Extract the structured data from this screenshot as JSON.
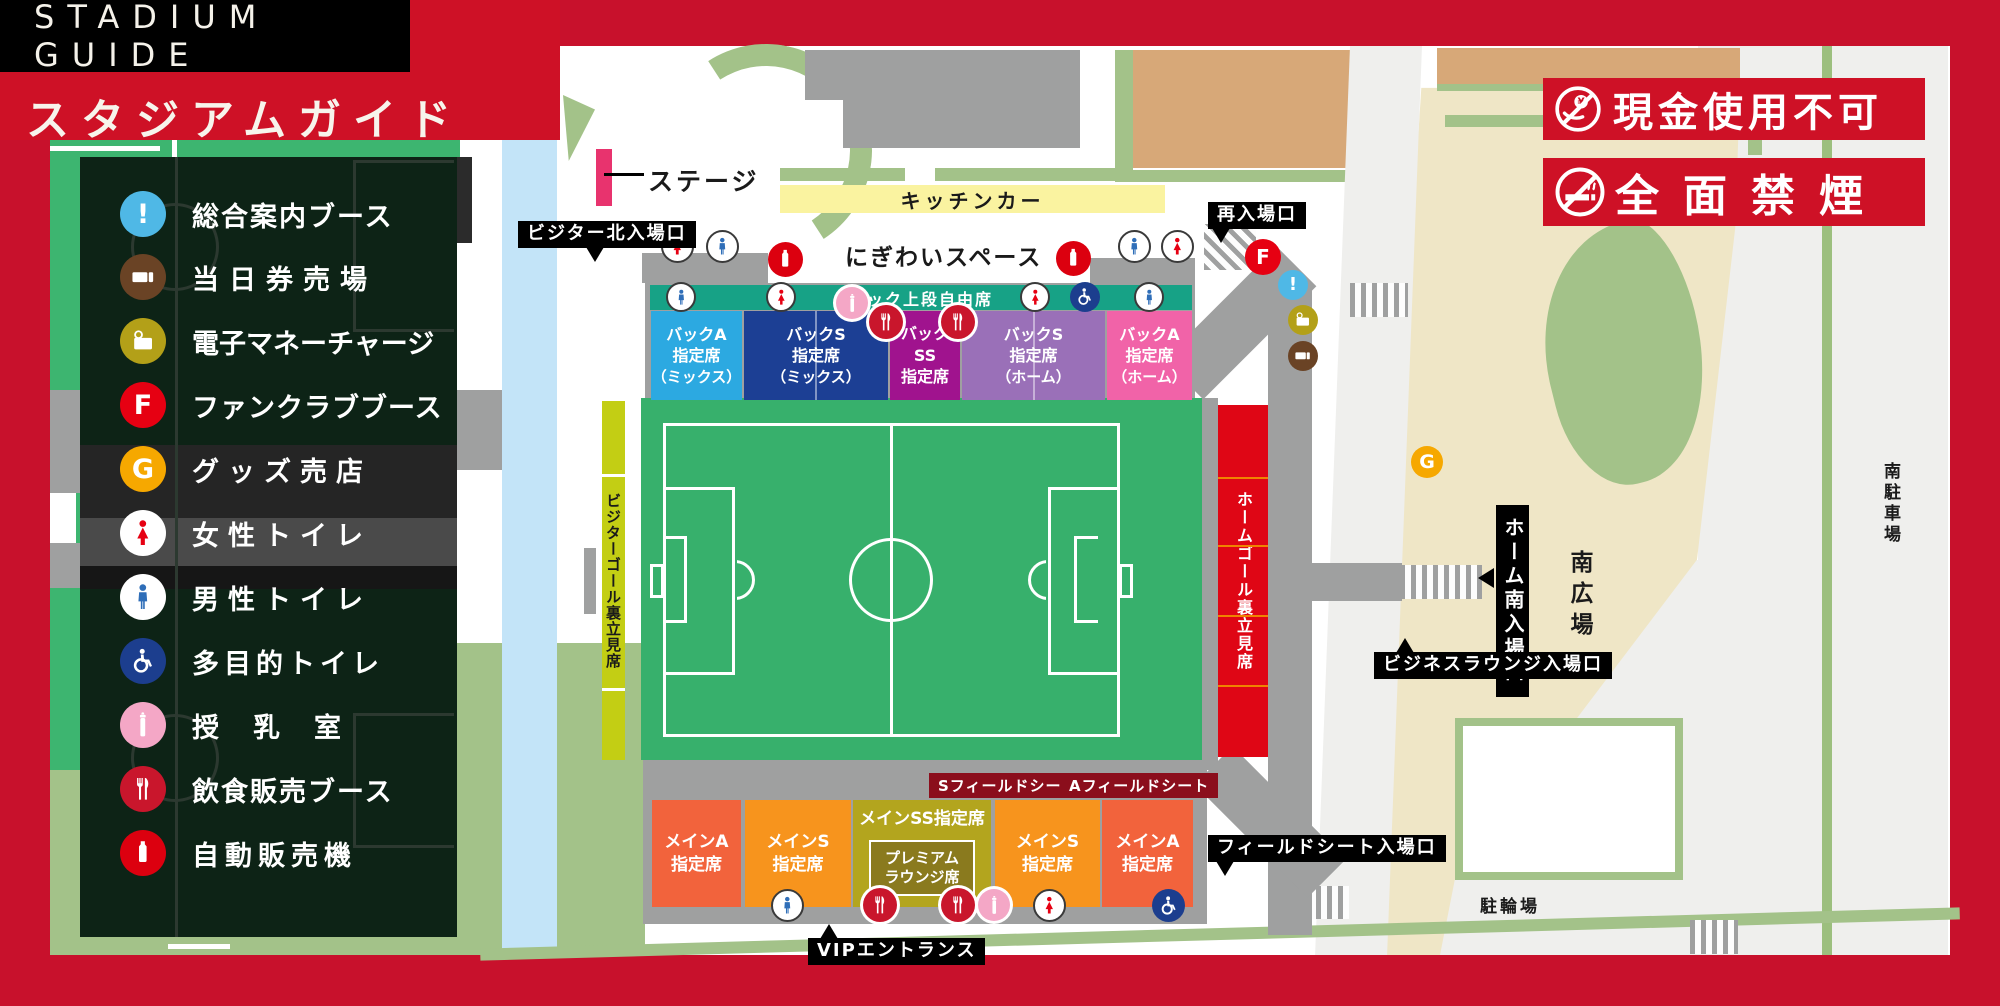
{
  "header": {
    "title_en": "STADIUM GUIDE",
    "title_ja": "スタジアムガイド"
  },
  "notices": [
    {
      "icon": "no-cash-icon",
      "label": "現金使用不可"
    },
    {
      "icon": "no-smoking-icon",
      "label": "全面禁煙"
    }
  ],
  "legend": {
    "items": [
      {
        "icon": "info-icon",
        "glyph": "!",
        "label": "総合案内ブース",
        "color": "#4FB8E6"
      },
      {
        "icon": "ticket-icon",
        "label": "当日券売場",
        "color": "#6A4325"
      },
      {
        "icon": "emoney-charge-icon",
        "label": "電子マネーチャージ",
        "color": "#B3A018"
      },
      {
        "icon": "fanclub-icon",
        "glyph": "F",
        "label": "ファンクラブブース",
        "color": "#E60012"
      },
      {
        "icon": "goods-icon",
        "glyph": "G",
        "label": "グッズ売店",
        "color": "#F6A800"
      },
      {
        "icon": "women-toilet-icon",
        "label": "女性トイレ",
        "color": "#E60012"
      },
      {
        "icon": "men-toilet-icon",
        "label": "男性トイレ",
        "color": "#2F6EB8"
      },
      {
        "icon": "accessible-toilet-icon",
        "label": "多目的トイレ",
        "color": "#1C3E8E"
      },
      {
        "icon": "nursing-room-icon",
        "label": "授乳室",
        "color": "#F4A7C6"
      },
      {
        "icon": "food-icon",
        "label": "飲食販売ブース",
        "color": "#C9162C"
      },
      {
        "icon": "vending-icon",
        "label": "自動販売機",
        "color": "#DC000F"
      }
    ]
  },
  "map": {
    "stage": "ステージ",
    "kitchen_car": "キッチンカー",
    "nigiwai_space": "にぎわいスペース",
    "entrances": {
      "visitor_north": "ビジター北入場口",
      "reentry": "再入場口",
      "home_south": "ホーム南入場口",
      "business_lounge": "ビジネスラウンジ入場口",
      "field_seat": "フィールドシート入場口",
      "vip": "VIPエントランス"
    },
    "areas": {
      "south_plaza": "南広場",
      "south_parking": "南駐車場",
      "bicycle_parking": "駐輪場"
    },
    "glyphs": {
      "goods": "G",
      "fanclub": "F",
      "info": "!"
    }
  },
  "stands": {
    "back_upper": {
      "label": "バック上段自由席",
      "color": "#17A286"
    },
    "back": [
      {
        "l1": "バックA",
        "l2": "指定席",
        "l3": "（ミックス）",
        "color": "#2CA9E1"
      },
      {
        "l1": "バックS",
        "l2": "指定席",
        "l3": "（ミックス）",
        "color": "#1C3F94"
      },
      {
        "l1": "バック",
        "l2": "SS",
        "l3": "指定席",
        "color": "#A0138E"
      },
      {
        "l1": "バックS",
        "l2": "指定席",
        "l3": "（ホーム）",
        "color": "#9A70B8"
      },
      {
        "l1": "バックA",
        "l2": "指定席",
        "l3": "（ホーム）",
        "color": "#F163A8"
      }
    ],
    "visitor_goal": {
      "label": "ビジターゴール裏立見席",
      "color": "#C3CE14"
    },
    "home_goal": {
      "label": "ホームゴール裏立見席",
      "color": "#DF0615"
    },
    "field_seats": [
      {
        "label": "Sフィールドシート"
      },
      {
        "label": "Aフィールドシート"
      }
    ],
    "main": [
      {
        "l1": "メインA",
        "l2": "指定席",
        "color": "#F2633C"
      },
      {
        "l1": "メインS",
        "l2": "指定席",
        "color": "#F7941D"
      },
      {
        "l1": "メインSS指定席",
        "color": "#B3A51E"
      },
      {
        "l1": "メインS",
        "l2": "指定席",
        "color": "#F7941D"
      },
      {
        "l1": "メインA",
        "l2": "指定席",
        "color": "#F2633C"
      }
    ],
    "premium": {
      "l1": "プレミアム",
      "l2": "ラウンジ席",
      "color": "#8A7A1E"
    }
  },
  "colors": {
    "frame_red": "#C8112C",
    "banner_red": "#CE1126",
    "pitch_green": "#37B06C",
    "concourse_gray": "#9FA0A0",
    "plaza_beige": "#EFE6C6",
    "hedge_green": "#A3C289",
    "river_blue": "#C3E4F8",
    "kitchen_yellow": "#FAF3A0",
    "field_seat_label_bg": "#8B0E1C",
    "stage_pink": "#E8336E"
  }
}
